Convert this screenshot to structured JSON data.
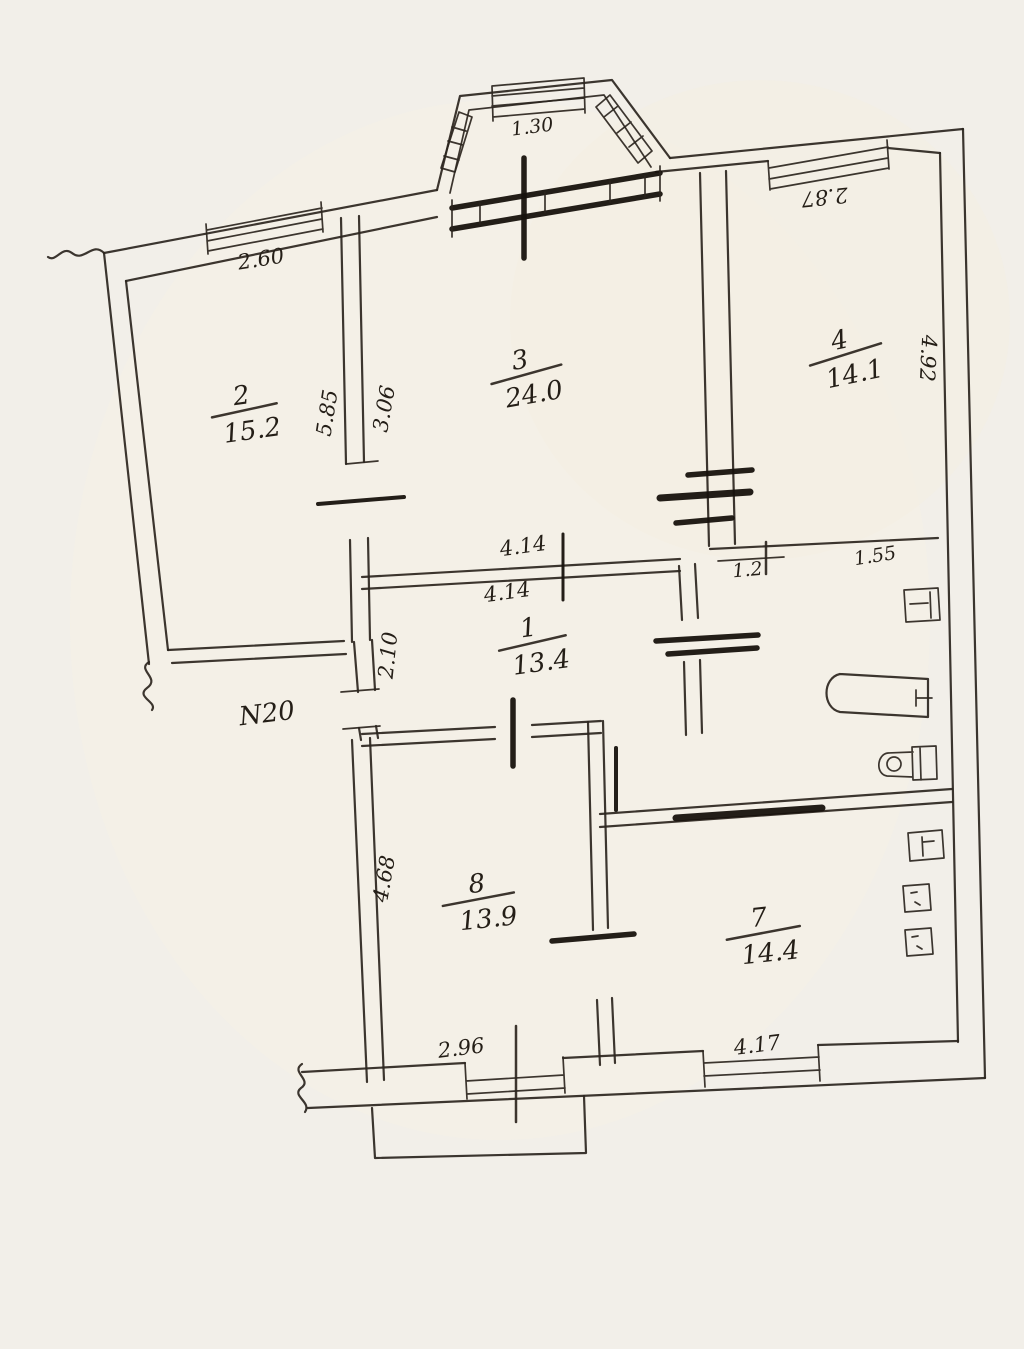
{
  "document": {
    "kind": "scanned hand-drawn apartment floor plan",
    "apartment_number": "N20",
    "paper_color": "#f2efe9",
    "ink_color": "#2b251e"
  },
  "rooms": [
    {
      "number": "2",
      "area": "15.2"
    },
    {
      "number": "3",
      "area": "24.0"
    },
    {
      "number": "4",
      "area": "14.1"
    },
    {
      "number": "1",
      "area": "13.4"
    },
    {
      "number": "8",
      "area": "13.9"
    },
    {
      "number": "7",
      "area": "14.4"
    }
  ],
  "labels": {
    "bay_width": "1.30",
    "window_top_left": "2.60",
    "window_top_right": "2.87",
    "room2_height_left": "5.85",
    "room3_height_left": "3.06",
    "room4_height_right": "4.92",
    "mid_width_upper": "4.14",
    "mid_width_lower": "4.14",
    "door_width": "1.2",
    "bath_width": "1.55",
    "hall_height": "2.10",
    "room8_height": "4.68",
    "room8_width_bottom": "2.96",
    "kitchen_width_bottom": "4.17",
    "apartment_number": "N20"
  }
}
